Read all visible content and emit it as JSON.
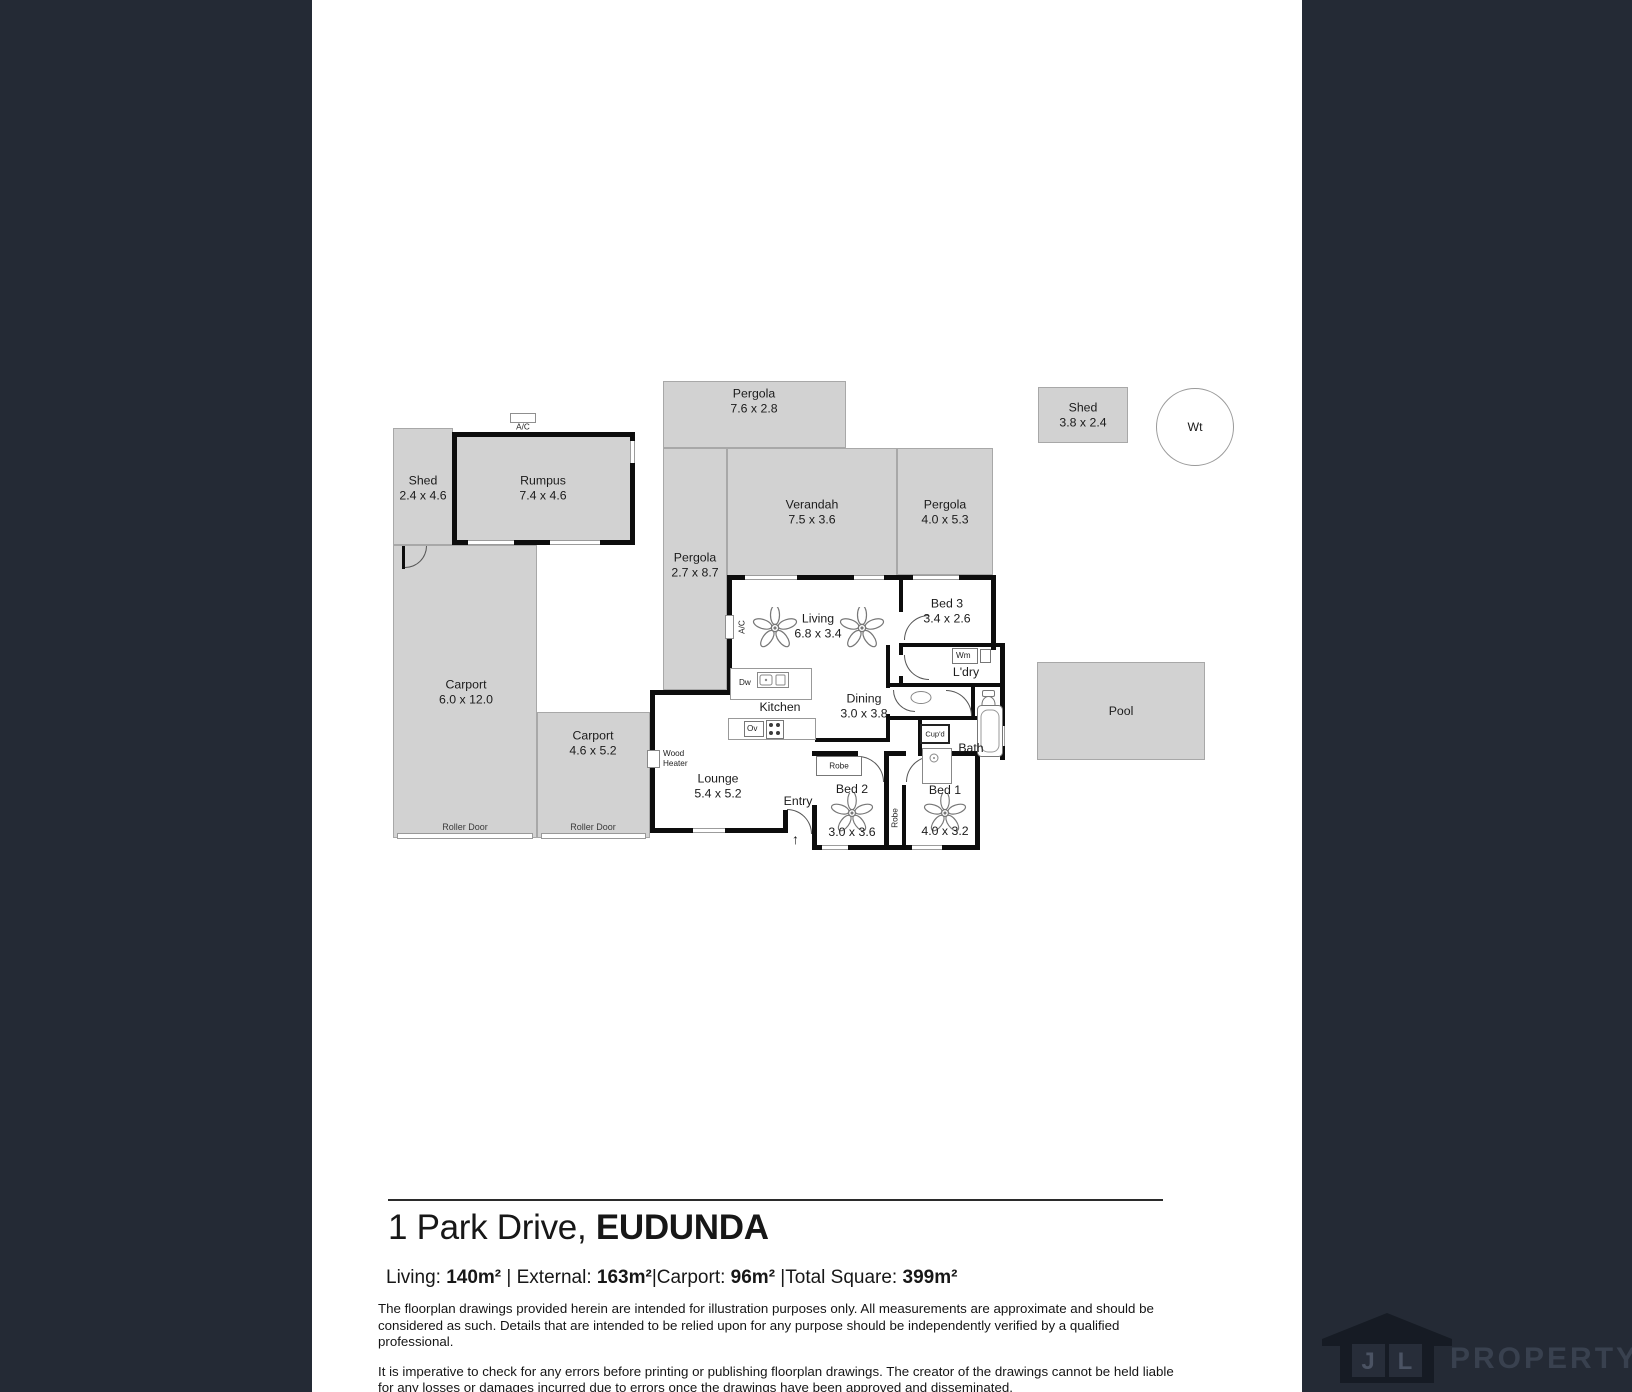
{
  "plan": {
    "areas": {
      "pergola_top": {
        "name": "Pergola",
        "dims": "7.6 x 2.8"
      },
      "shed_top": {
        "name": "Shed",
        "dims": "3.8 x 2.4"
      },
      "water_tank": {
        "name": "Wt"
      },
      "shed_left": {
        "name": "Shed",
        "dims": "2.4 x 4.6"
      },
      "rumpus": {
        "name": "Rumpus",
        "dims": "7.4 x 4.6"
      },
      "verandah": {
        "name": "Verandah",
        "dims": "7.5 x 3.6"
      },
      "pergola_right": {
        "name": "Pergola",
        "dims": "4.0 x 5.3"
      },
      "pergola_mid": {
        "name": "Pergola",
        "dims": "2.7 x 8.7"
      },
      "carport_main": {
        "name": "Carport",
        "dims": "6.0 x 12.0"
      },
      "carport_second": {
        "name": "Carport",
        "dims": "4.6 x 5.2"
      },
      "pool": {
        "name": "Pool"
      },
      "living": {
        "name": "Living",
        "dims": "6.8 x 3.4"
      },
      "bed3": {
        "name": "Bed 3",
        "dims": "3.4 x 2.6"
      },
      "ldry": {
        "name": "L'dry"
      },
      "kitchen": {
        "name": "Kitchen"
      },
      "dining": {
        "name": "Dining",
        "dims": "3.0 x 3.8"
      },
      "bath": {
        "name": "Bath"
      },
      "lounge": {
        "name": "Lounge",
        "dims": "5.4 x 5.2"
      },
      "entry": {
        "name": "Entry"
      },
      "bed2": {
        "name": "Bed 2",
        "dims": "3.0 x 3.6"
      },
      "bed1": {
        "name": "Bed 1",
        "dims": "4.0 x 3.2"
      }
    },
    "fixtures": {
      "ac": "A/C",
      "dw": "Dw",
      "ov": "Ov",
      "wm": "Wm",
      "cupd": "Cup'd",
      "robe": "Robe",
      "wood_heater_line1": "Wood",
      "wood_heater_line2": "Heater",
      "roller_door": "Roller Door",
      "entry_arrow": "↑"
    }
  },
  "footer": {
    "address_main": "1 Park Drive, ",
    "address_suburb": "EUDUNDA",
    "area_items": [
      {
        "label": "Living: ",
        "value": "140m²",
        "sep": " | "
      },
      {
        "label": "External: ",
        "value": "163m²",
        "sep": "|"
      },
      {
        "label": "Carport: ",
        "value": "96m²",
        "sep": " |"
      },
      {
        "label": "Total Square: ",
        "value": "399m²",
        "sep": ""
      }
    ],
    "disclaimer_p1": "The floorplan drawings provided herein are intended for illustration purposes only. All measurements are approximate and should be considered as such. Details that are intended to be relied upon for any purpose should be independently verified by a qualified professional.",
    "disclaimer_p2": "It is imperative to check for any errors before printing or publishing floorplan drawings. The creator of the drawings cannot be held liable for any losses or damages incurred due to errors once the drawings have been approved and disseminated."
  },
  "logo": {
    "letter_j": "J",
    "letter_l": "L",
    "wordmark": "PROPERTY"
  },
  "colors": {
    "band": "#242a35",
    "area_fill": "#d2d2d2",
    "wall": "#0d0d0d"
  }
}
